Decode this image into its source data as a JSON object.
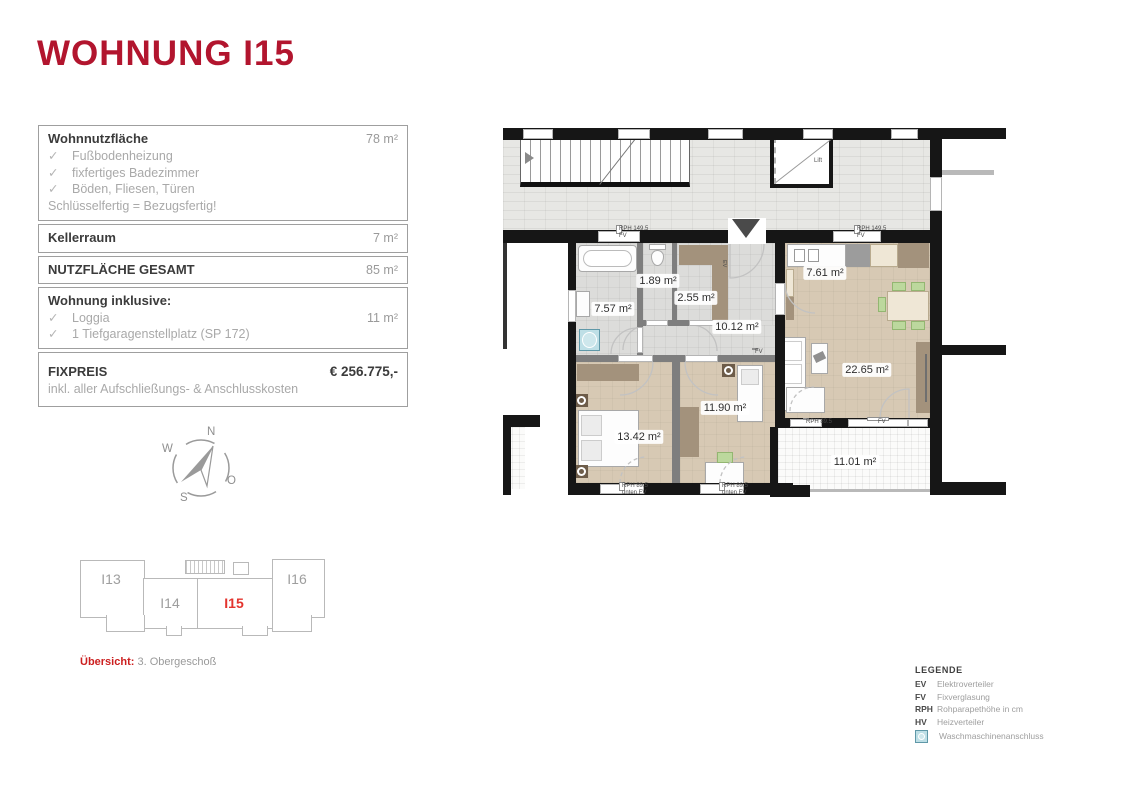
{
  "title": "WOHNUNG I15",
  "colors": {
    "accent_dark_red": "#b2152e",
    "unit_red": "#e3342e",
    "wall": "#161616",
    "floor_tan": "#d7c9b4",
    "floor_gray": "#dcdcda"
  },
  "info_table": {
    "check_glyph": "✓",
    "sections": [
      {
        "label": "Wohnnutzfläche",
        "value": "78 m²",
        "checks": [
          "Fußbodenheizung",
          "fixfertiges Badezimmer",
          "Böden, Fliesen, Türen"
        ],
        "note": "Schlüsselfertig = Bezugsfertig!"
      },
      {
        "label": "Kellerraum",
        "value": "7 m²"
      },
      {
        "label": "NUTZFLÄCHE GESAMT",
        "value": "85 m²"
      },
      {
        "label": "Wohnung inklusive:",
        "checks": [
          "Loggia",
          "1 Tiefgaragenstellplatz (SP 172)"
        ],
        "check_value": "11 m²"
      },
      {
        "label": "FIXPREIS",
        "value": "€ 256.775,-",
        "note": "inkl. aller Aufschließungs- & Anschlusskosten"
      }
    ]
  },
  "compass": {
    "n": "N",
    "w": "W",
    "s": "S",
    "o": "O"
  },
  "plan": {
    "rooms": {
      "bath": "7.57 m²",
      "wc": "1.89 m²",
      "storage": "2.55 m²",
      "hall": "10.12 m²",
      "kitchen": "7.61 m²",
      "living": "22.65 m²",
      "bedroom1": "13.42 m²",
      "bedroom2": "11.90 m²",
      "loggia": "11.01 m²"
    },
    "labels": {
      "lift": "Lift",
      "rph_149": "RPH 149.5",
      "fv": "FV",
      "rph_89": "RPH 89.5",
      "unten_fv": "unten FV",
      "ev": "EV"
    }
  },
  "overview": {
    "units": [
      {
        "id": "I13"
      },
      {
        "id": "I14"
      },
      {
        "id": "I15"
      },
      {
        "id": "I16"
      }
    ],
    "caption_label": "Übersicht:",
    "caption_value": "3. Obergeschoß"
  },
  "legend": {
    "title": "LEGENDE",
    "entries": [
      {
        "abbr": "EV",
        "desc": "Elektroverteiler"
      },
      {
        "abbr": "FV",
        "desc": "Fixverglasung"
      },
      {
        "abbr": "RPH",
        "desc": "Rohparapethöhe in cm"
      },
      {
        "abbr": "HV",
        "desc": "Heizverteiler"
      }
    ],
    "washer_desc": "Waschmaschinenanschluss"
  }
}
